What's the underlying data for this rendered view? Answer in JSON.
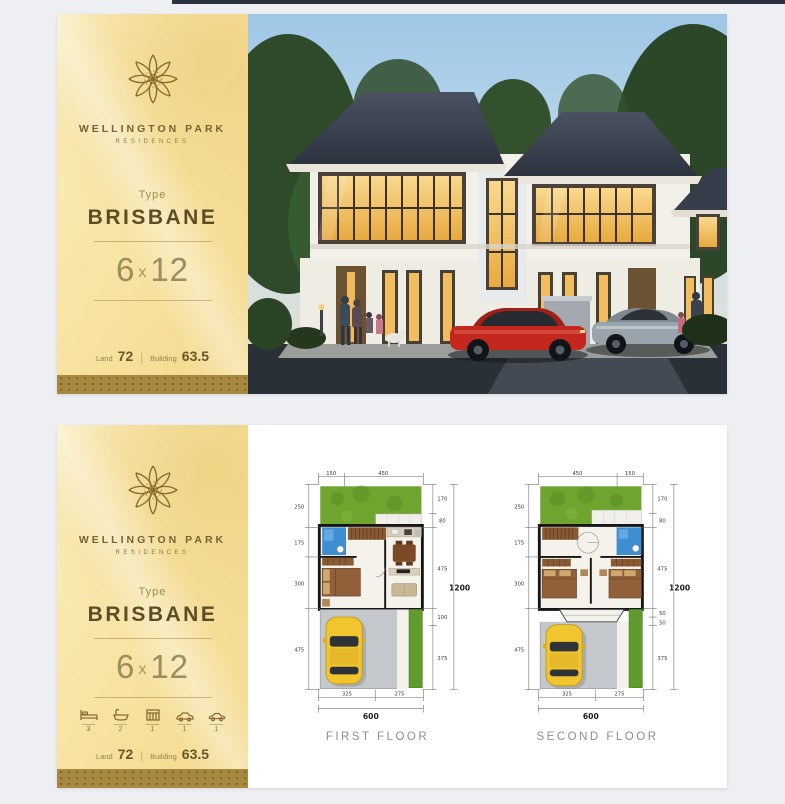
{
  "colors": {
    "accent_gold": "#a8873e",
    "sidebar_yellow": "#f7e3a2",
    "brand_brown": "#6a5628",
    "plan_green": "#6fa42f",
    "plan_blue": "#3e8ed2",
    "car_yellow": "#f0c52e",
    "car_red": "#c3271d",
    "roof_dark": "#3a4150"
  },
  "brand": {
    "logo": "flower-mandala",
    "name": "WELLINGTON PARK",
    "subtitle": "RESIDENCES",
    "type_label": "Type",
    "type_name": "BRISBANE",
    "size_a": "6",
    "size_x": "x",
    "size_b": "12",
    "land_label": "Land",
    "land_value": "72",
    "divider": "|",
    "building_label": "Building",
    "building_value": "63.5"
  },
  "amenities": {
    "items": [
      {
        "icon": "bed-icon",
        "count": "3"
      },
      {
        "icon": "bath-icon",
        "count": "2"
      },
      {
        "icon": "stove-icon",
        "count": "1"
      },
      {
        "icon": "carport-icon",
        "count": "1"
      },
      {
        "icon": "car-icon",
        "count": "1"
      }
    ]
  },
  "plans": [
    {
      "caption": "FIRST FLOOR",
      "top_dims": [
        "150",
        "450"
      ],
      "left_dims": [
        "250",
        "175",
        "300",
        "475"
      ],
      "right_dims": [
        "170",
        "80",
        "475",
        "100",
        "375"
      ],
      "right_total": "1200",
      "bottom_dims": [
        "325",
        "275"
      ],
      "bottom_total": "600"
    },
    {
      "caption": "SECOND FLOOR",
      "top_dims": [
        "450",
        "150"
      ],
      "left_dims": [
        "250",
        "175",
        "300",
        "475"
      ],
      "right_dims": [
        "170",
        "80",
        "475",
        "50",
        "50",
        "375"
      ],
      "right_total": "1200",
      "bottom_dims": [
        "325",
        "275"
      ],
      "bottom_total": "600"
    }
  ]
}
